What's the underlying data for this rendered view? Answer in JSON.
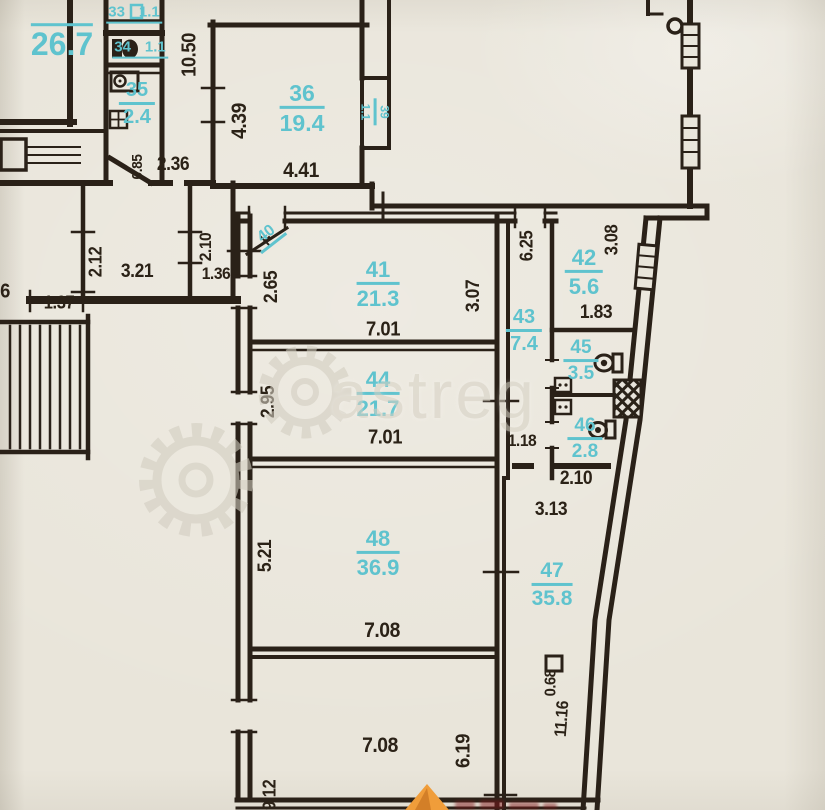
{
  "page": {
    "type": "floor-plan-photo"
  },
  "colors": {
    "paper": "#e9e5da",
    "ink": "#2a2118",
    "room_label": "#5fc3ce",
    "watermark": "#d7d2c5",
    "logo_orange": "#f09d3a"
  },
  "watermark": {
    "text": "astreg"
  },
  "rooms": {
    "r267": {
      "number": "",
      "area": "26.7"
    },
    "r33": {
      "number": "33",
      "area": "1.1"
    },
    "r34": {
      "number": "34",
      "area": "1.1"
    },
    "r35": {
      "number": "35",
      "area": "2.4"
    },
    "r36": {
      "number": "36",
      "area": "19.4"
    },
    "r39": {
      "number": "39",
      "area": "1.1"
    },
    "r40": {
      "number": "40",
      "area": ""
    },
    "r41": {
      "number": "41",
      "area": "21.3"
    },
    "r42": {
      "number": "42",
      "area": "5.6"
    },
    "r43": {
      "number": "43",
      "area": "7.4"
    },
    "r44": {
      "number": "44",
      "area": "21.7"
    },
    "r45": {
      "number": "45",
      "area": "3.5"
    },
    "r46": {
      "number": "46",
      "area": "2.8"
    },
    "r47": {
      "number": "47",
      "area": "35.8"
    },
    "r48": {
      "number": "48",
      "area": "36.9"
    }
  },
  "dims": {
    "d1050": "10.50",
    "d439": "4.39",
    "d441": "4.41",
    "d236": "2.36",
    "d085": "0.85",
    "d6": "6",
    "d212": "2.12",
    "d321": "3.21",
    "d137": "1.37",
    "d210a": "2.10",
    "d136": "1.36",
    "d265": "2.65",
    "d307": "3.07",
    "d701a": "7.01",
    "d625": "6.25",
    "d308": "3.08",
    "d183": "1.83",
    "d295": "2.95",
    "d701b": "7.01",
    "d118": "1.18",
    "d210b": "2.10",
    "d313": "3.13",
    "d521": "5.21",
    "d708a": "7.08",
    "d068": "0.68",
    "d1116": "11.16",
    "d708b": "7.08",
    "d619": "6.19",
    "d912": "9.12"
  }
}
